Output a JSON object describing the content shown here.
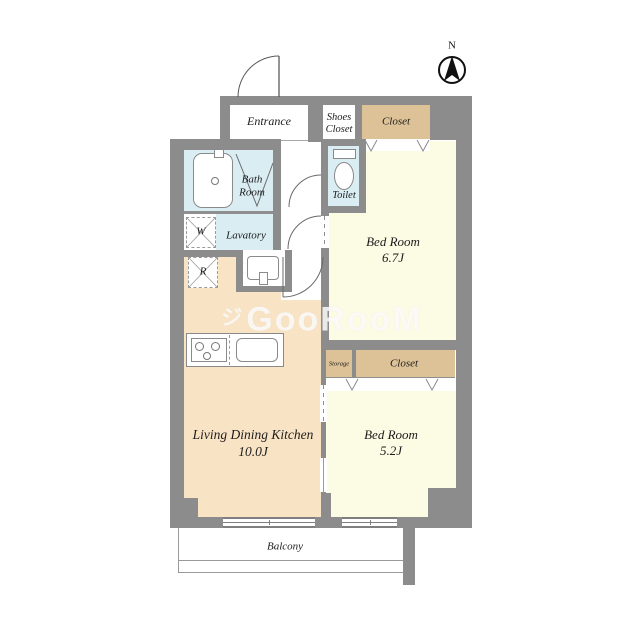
{
  "compass": {
    "label": "N"
  },
  "watermark": {
    "prefix": "ジ",
    "text": "GooRooM"
  },
  "colors": {
    "wall": "#8c8c8c",
    "water_rooms": "#d9edf2",
    "closet": "#ddc297",
    "bedroom_floor": "#fcfbe4",
    "ldk_floor": "#f9e3c5",
    "fixture_outline": "#8a8a8a"
  },
  "rooms": {
    "entrance": {
      "label": "Entrance"
    },
    "shoes_closet": {
      "line1": "Shoes",
      "line2": "Closet"
    },
    "closet_north": {
      "label": "Closet"
    },
    "bath": {
      "line1": "Bath",
      "line2": "Room"
    },
    "toilet": {
      "label": "Toilet"
    },
    "lavatory": {
      "label": "Lavatory"
    },
    "washer": {
      "label": "W"
    },
    "refrigerator": {
      "label": "R"
    },
    "bedroom_north": {
      "line1": "Bed Room",
      "line2": "6.7J"
    },
    "storage": {
      "label": "Storage"
    },
    "closet_south": {
      "label": "Closet"
    },
    "bedroom_south": {
      "line1": "Bed Room",
      "line2": "5.2J"
    },
    "ldk": {
      "line1": "Living Dining Kitchen",
      "line2": "10.0J"
    },
    "balcony": {
      "label": "Balcony"
    }
  }
}
